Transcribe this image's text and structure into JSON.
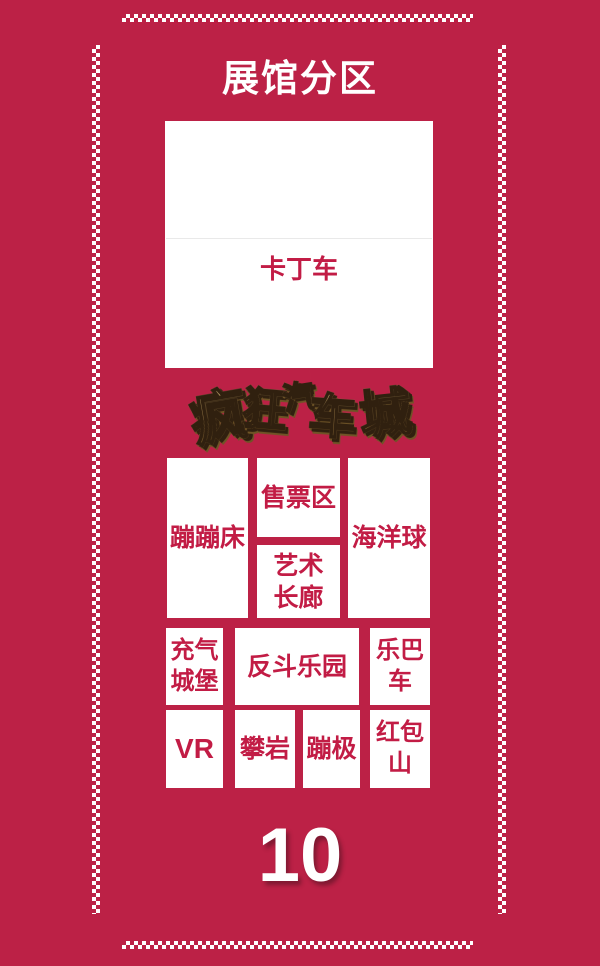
{
  "page": {
    "title": "展馆分区",
    "hall_number": "10"
  },
  "logo": {
    "name": "疯狂汽车城",
    "chars": [
      "疯",
      "狂",
      "汽",
      "车",
      "城"
    ]
  },
  "zones": [
    {
      "id": "karting",
      "label": "卡丁车"
    },
    {
      "id": "trampoline",
      "label": "蹦蹦床"
    },
    {
      "id": "ticket-office",
      "label": "售票区"
    },
    {
      "id": "art-corridor",
      "label": "艺术\n长廊"
    },
    {
      "id": "ocean-ball-pool",
      "label": "海洋球"
    },
    {
      "id": "inflatable-castle",
      "label": "充气\n城堡"
    },
    {
      "id": "fandou-playground",
      "label": "反斗乐园"
    },
    {
      "id": "fun-bus",
      "label": "乐巴\n车"
    },
    {
      "id": "vr",
      "label": "VR"
    },
    {
      "id": "rock-climbing",
      "label": "攀岩"
    },
    {
      "id": "bungee",
      "label": "蹦极"
    },
    {
      "id": "red-packet-mountain",
      "label": "红包\n山"
    }
  ],
  "colors": {
    "background": "#bc2146",
    "zone_fill": "#ffffff",
    "zone_text": "#c21c45",
    "title_text": "#ffffff",
    "logo_gold": "#d9b26b",
    "logo_outline": "#30200f"
  }
}
